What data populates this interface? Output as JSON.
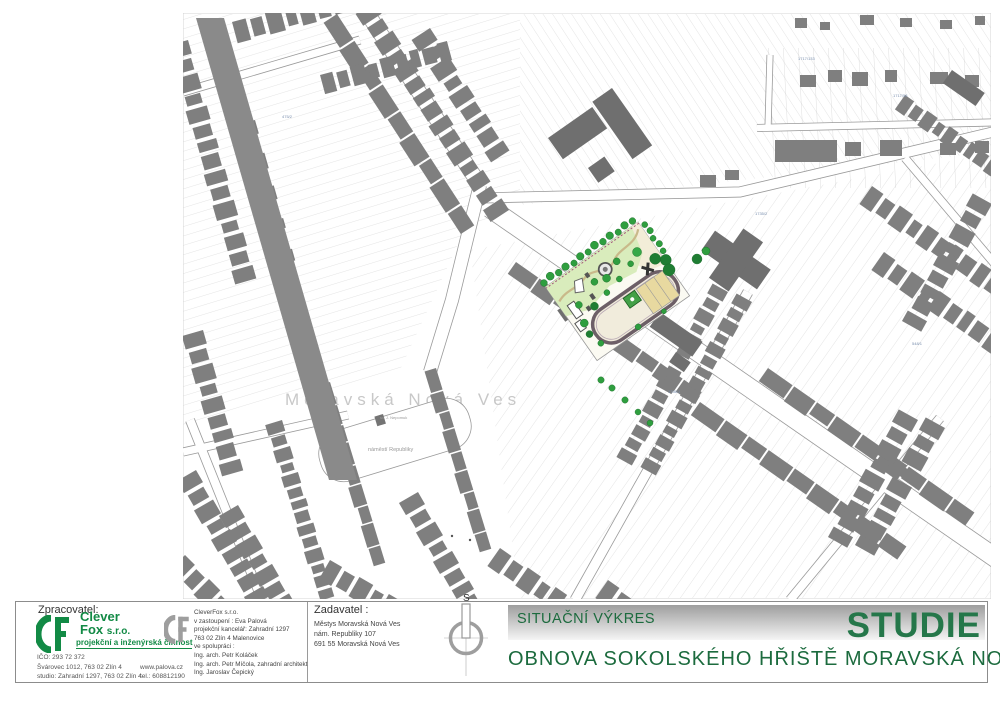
{
  "project": {
    "drawing_type": "SITUAČNÍ VÝKRES",
    "stage": "STUDIE",
    "title": "OBNOVA SOKOLSKÉHO HŘIŠTĚ MORAVSKÁ NOVÁ VES"
  },
  "zpracovatel": {
    "label": "Zpracovatel:",
    "logo": {
      "line1": "Clever",
      "line2": "Fox",
      "sro": "s.r.o.",
      "tagline": "projekční a inženýrská činnost"
    },
    "ico": "IČO: 293 72 372",
    "address1": "Švárovec 1012, 763 02 Zlín 4",
    "address2": "studio: Zahradní 1297, 763 02 Zlín 4",
    "web": "www.palova.cz",
    "tel": "tel.: 608812190",
    "company": {
      "name": "CleverFox s.r.o.",
      "represented": "v zastoupení : Eva Palová",
      "office": "projekční kancelář: Zahradní 1297",
      "city": "763 02 Zlín 4 Malenovice",
      "cooperation": "ve spolupráci :",
      "coop1": "Ing. arch. Petr Koláček",
      "coop2": "Ing. arch. Petr Míčola, zahradní architekt",
      "coop3": "Ing. Jaroslav Čepický"
    }
  },
  "zadavatel": {
    "label": "Zadavatel :",
    "line1": "Městys Moravská Nová Ves",
    "line2": "nám. Republiky 107",
    "line3": "691 55 Moravská Nová Ves"
  },
  "compass": {
    "north_label": "S"
  },
  "map": {
    "town_label": "Moravská Nová Ves",
    "square_label": "náměstí Republiky",
    "chapel_label": "sv. J. Nepomuk",
    "parcels": [
      "1717/133",
      "1717/58",
      "1735/2",
      "1786/1",
      "548/1",
      "475/2"
    ]
  },
  "colors": {
    "title_green": "#1c6b3e",
    "logo_green": "#128a45",
    "building_gray": "#7f7f7f",
    "track_outline": "#6d5f67",
    "lawn_green": "#d9ecbc",
    "tree_green": "#2f9e3f"
  }
}
